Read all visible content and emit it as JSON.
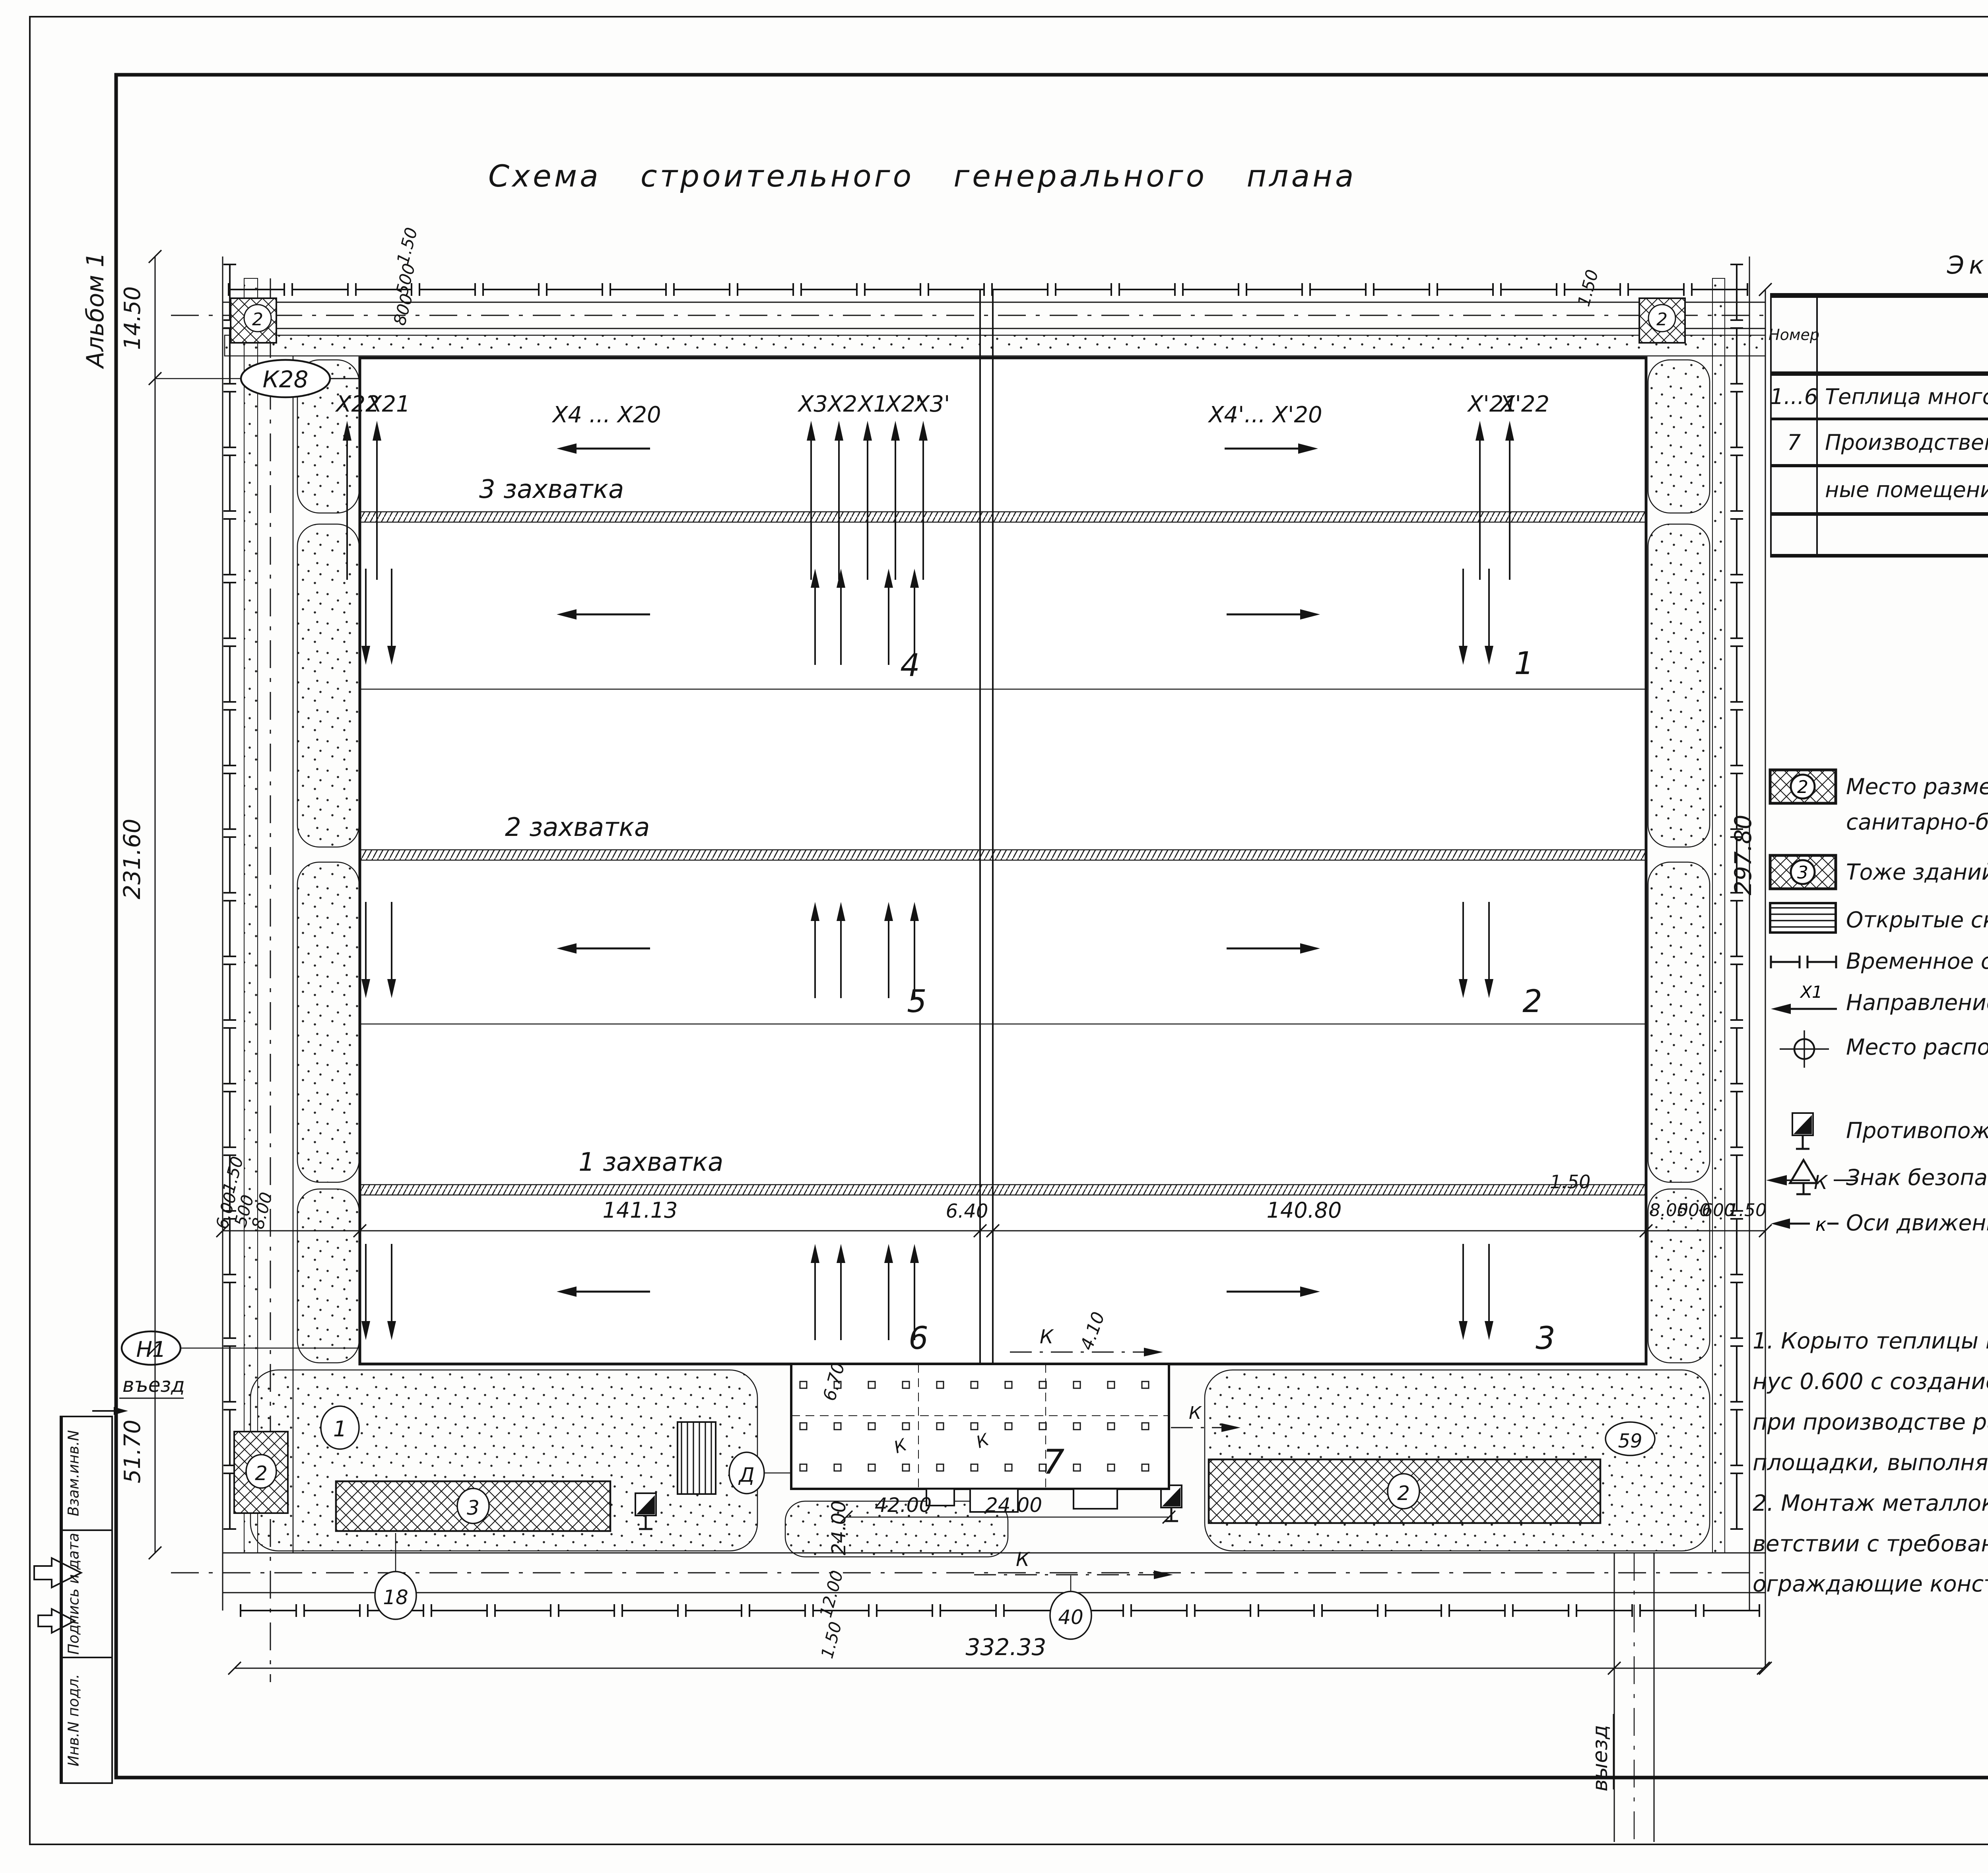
{
  "page": {
    "corner_sheet": "18",
    "album": "Альбом 1",
    "title": "Схема строительного генерального плана",
    "copied": "Копировал Кухтинова",
    "format": "ФорматА2",
    "doc_code": "23534-01",
    "doc_sheet": "19"
  },
  "stamps": {
    "col_bottom": "Инв.N подл.",
    "col_middle": "Подпись и дата",
    "col_top": "Взам.инв.N"
  },
  "explication": {
    "title": "Экспликация помещений",
    "columns": [
      "Номер",
      "Наименование",
      "Примечание"
    ],
    "rows": [
      {
        "num": "1...6",
        "name": "Теплица многопролетная",
        "note": ""
      },
      {
        "num": "7",
        "name": "Производственные и вспомогатель-",
        "note": ""
      },
      {
        "num": "",
        "name": "ные помещения",
        "note": ""
      },
      {
        "num": "",
        "name": "",
        "note": ""
      }
    ]
  },
  "legend": {
    "title": "Условные обозначения",
    "items": [
      {
        "symbol": "hatched-box-2",
        "badge": "2",
        "text": "Место размещения временных зданий админис- тративного и санитарно-бытового назначения"
      },
      {
        "symbol": "hatched-box-3",
        "badge": "3",
        "text": "Тоже зданий складского назначения"
      },
      {
        "symbol": "open-storage",
        "text": "Открытые складские площадки"
      },
      {
        "symbol": "temp-fence",
        "text": "Временное ограждение по ГОСТ 23407-78"
      },
      {
        "symbol": "work-direction",
        "axis": "X1",
        "text": "Направление производства работ по пролетам"
      },
      {
        "symbol": "axis-marker",
        "text": "Место расположения знаков закрепления разбивочных осей"
      },
      {
        "symbol": "fire-shield",
        "text": "Противопожарный щит"
      },
      {
        "symbol": "safety-sign",
        "text": "Знак безопасности"
      },
      {
        "symbol": "crane-axis",
        "axis": "к",
        "text": "Оси движения крана при монтаже конструкций покрытия"
      }
    ]
  },
  "notes": {
    "n1": [
      "1. Корыто теплицы выполняется  на  отметке  ми-",
      "нус 0.600 с созданием  проектного  уклона  к дренам",
      "при производстве работ по вертикальной планировке",
      "площадки, выполняемой  в  подготовительный  период."
    ],
    "n2": [
      "2. Монтаж металлоконструкций теплиц  выполнять  в соот-",
      "ветствии с требованиями СНиП 3.03.01-87 „Несущие и",
      "ограждающие конструкции\"."
    ]
  },
  "titleblock": {
    "privyazan": "Привязан",
    "inv_n": "Инв.N",
    "doc": "т.п.  810-1-30.88",
    "code": "ПЗ",
    "sheet_label": "Лист",
    "sheet_value": "16"
  },
  "plan": {
    "axes": {
      "x22": "X22",
      "x21": "X21",
      "left_range": "X4 ... X20",
      "x3": "X3",
      "x2": "X2",
      "x1": "X1",
      "x2p": "X2'",
      "x3p": "X3'",
      "right_range": "X4'... X'20",
      "x21p": "X'21",
      "x22p": "X'22"
    },
    "zones": {
      "z3": "3 захватка",
      "z2": "2 захватка",
      "z1": "1 захватка"
    },
    "spans": {
      "s4": "4",
      "s1": "1",
      "s5": "5",
      "s2": "2",
      "s6": "6",
      "s3": "3"
    },
    "marks": {
      "k28": "К28",
      "n1": "Н1",
      "b7": "7",
      "row_d": "Д",
      "c1": "1",
      "c2": "2",
      "c3": "3",
      "c59": "59",
      "c18": "18",
      "c40": "40",
      "corner_left": "2",
      "corner_right": "2",
      "c2b": "2",
      "k": "К",
      "entry": "въезд",
      "exit": "выезд"
    },
    "dims": {
      "left_top": "14.50",
      "left_main": "231.60",
      "left_bottom": "51.70",
      "right_main": "297.80",
      "bottom_main": "332.33",
      "t1": "1.50",
      "t2": "800",
      "t3": "500",
      "bl0": "1.50",
      "bl1": "6.00",
      "bl2": "500",
      "bl3": "8.00",
      "bc1": "141.13",
      "bc2": "6.40",
      "bc3": "140.80",
      "br0": "1.50",
      "br1": "8.00",
      "br2": "500",
      "br3": "600",
      "br4": "1.50",
      "g_vert": "24.00",
      "g_w1": "42.00",
      "g_w2": "24.00",
      "g_h": "6.70",
      "g_d": "4.10",
      "g_b1": "12.00",
      "g_b2": "1.50"
    }
  }
}
